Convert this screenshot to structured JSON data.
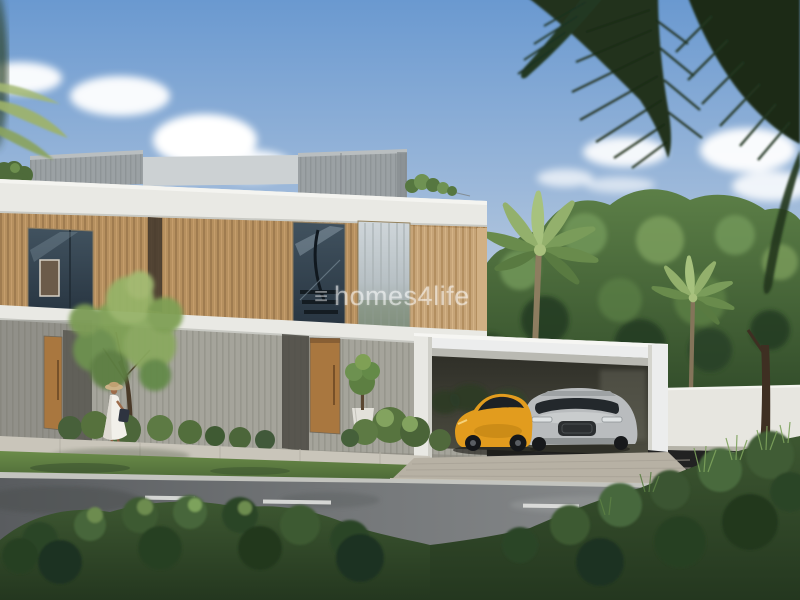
{
  "watermark": {
    "logo_glyph": "≡",
    "text": "homes4life"
  },
  "palette": {
    "sky_top": "#6a99d0",
    "sky_mid": "#9db9da",
    "sky_horizon": "#dde3e8",
    "slab_white": "#e9e9e4",
    "wood_panel": "#b6905f",
    "wood_panel_light": "#c6a478",
    "roof_gray": "#9ba1a4",
    "ground_slat_gray": "#a5a49b",
    "door_wood": "#a9773f",
    "sports_car_orange": "#e29c1e",
    "suv_silver": "#b9bcbe",
    "boundary_wall": "#e7e6e0",
    "road_dark": "#595c5f",
    "road_light": "#8f9293",
    "lawn_green": "#6b8c49",
    "shrub_dark": "#24371f",
    "palm_frond_dark": "#20331d",
    "tree_canopy": "#4f7040"
  }
}
